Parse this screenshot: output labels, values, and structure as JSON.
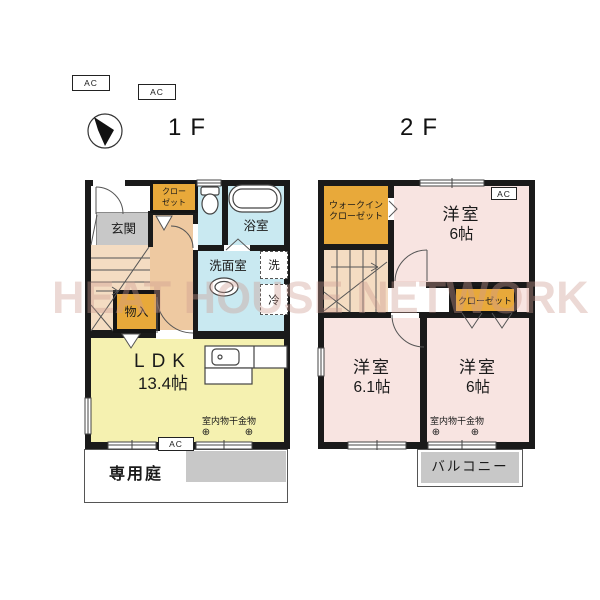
{
  "colors": {
    "wall": "#1a1a1a",
    "water": "#c9e9f1",
    "ldk": "#f5f1b0",
    "bedroom": "#f8e4e1",
    "closet": "#e8a93a",
    "corridor": "#eec9a1",
    "stairs": "#f4dcc2",
    "gray": "#c8c8c8",
    "text": "#1a1a1a",
    "watermark": "rgba(205,155,145,0.38)"
  },
  "watermark": "HEAT HOUSE NETWORK",
  "symbols": {
    "hook": "⊕"
  },
  "top": {
    "ac1": "AC",
    "ac2": "AC",
    "floor1": "1F",
    "floor2": "2F",
    "compass": "north-arrow"
  },
  "floor1": {
    "entrance": "玄関",
    "closet_line1": "クロー",
    "closet_line2": "ゼット",
    "bath": "浴室",
    "washroom": "洗面室",
    "washer": "洗",
    "fridge": "冷",
    "storage": "物入",
    "ldk": "LDK",
    "ldk_size": "13.4帖",
    "laundry": "室内物干金物",
    "ac": "AC",
    "garden": "専用庭"
  },
  "floor2": {
    "wic_line1": "ウォークイン",
    "wic_line2": "クローゼット",
    "room_top": "洋室",
    "room_top_size": "6帖",
    "ac": "AC",
    "closet": "クローゼット",
    "room_left": "洋室",
    "room_left_size": "6.1帖",
    "room_right": "洋室",
    "room_right_size": "6帖",
    "laundry": "室内物干金物",
    "balcony": "バルコニー"
  }
}
